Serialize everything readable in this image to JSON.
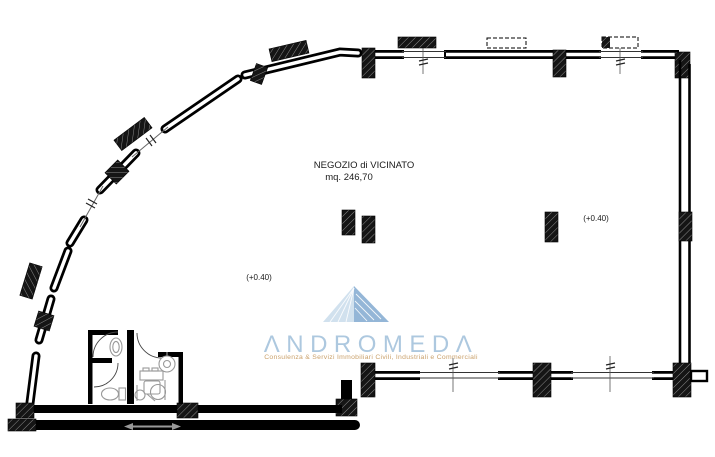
{
  "page": {
    "background": "#ffffff",
    "ink_color": "#000000",
    "fixture_color": "#999999"
  },
  "plan": {
    "room_label": {
      "line1": "NEGOZIO di VICINATO",
      "line2": "mq.  246,70"
    },
    "elevation_labels": [
      {
        "text": "(+0.40)"
      },
      {
        "text": "(+0.40)"
      }
    ]
  },
  "watermark": {
    "brand": "ANDROMEDA",
    "brand_display": "ΛNDROMEDΛ",
    "tagline": "Consulenza & Servizi Immobiliari Civili, Industriali e Commerciali",
    "brand_color": "#a9c6de",
    "tagline_color": "#c79b62",
    "triangle_light": "#cfe0ee",
    "triangle_dark": "#8fb3d5"
  }
}
